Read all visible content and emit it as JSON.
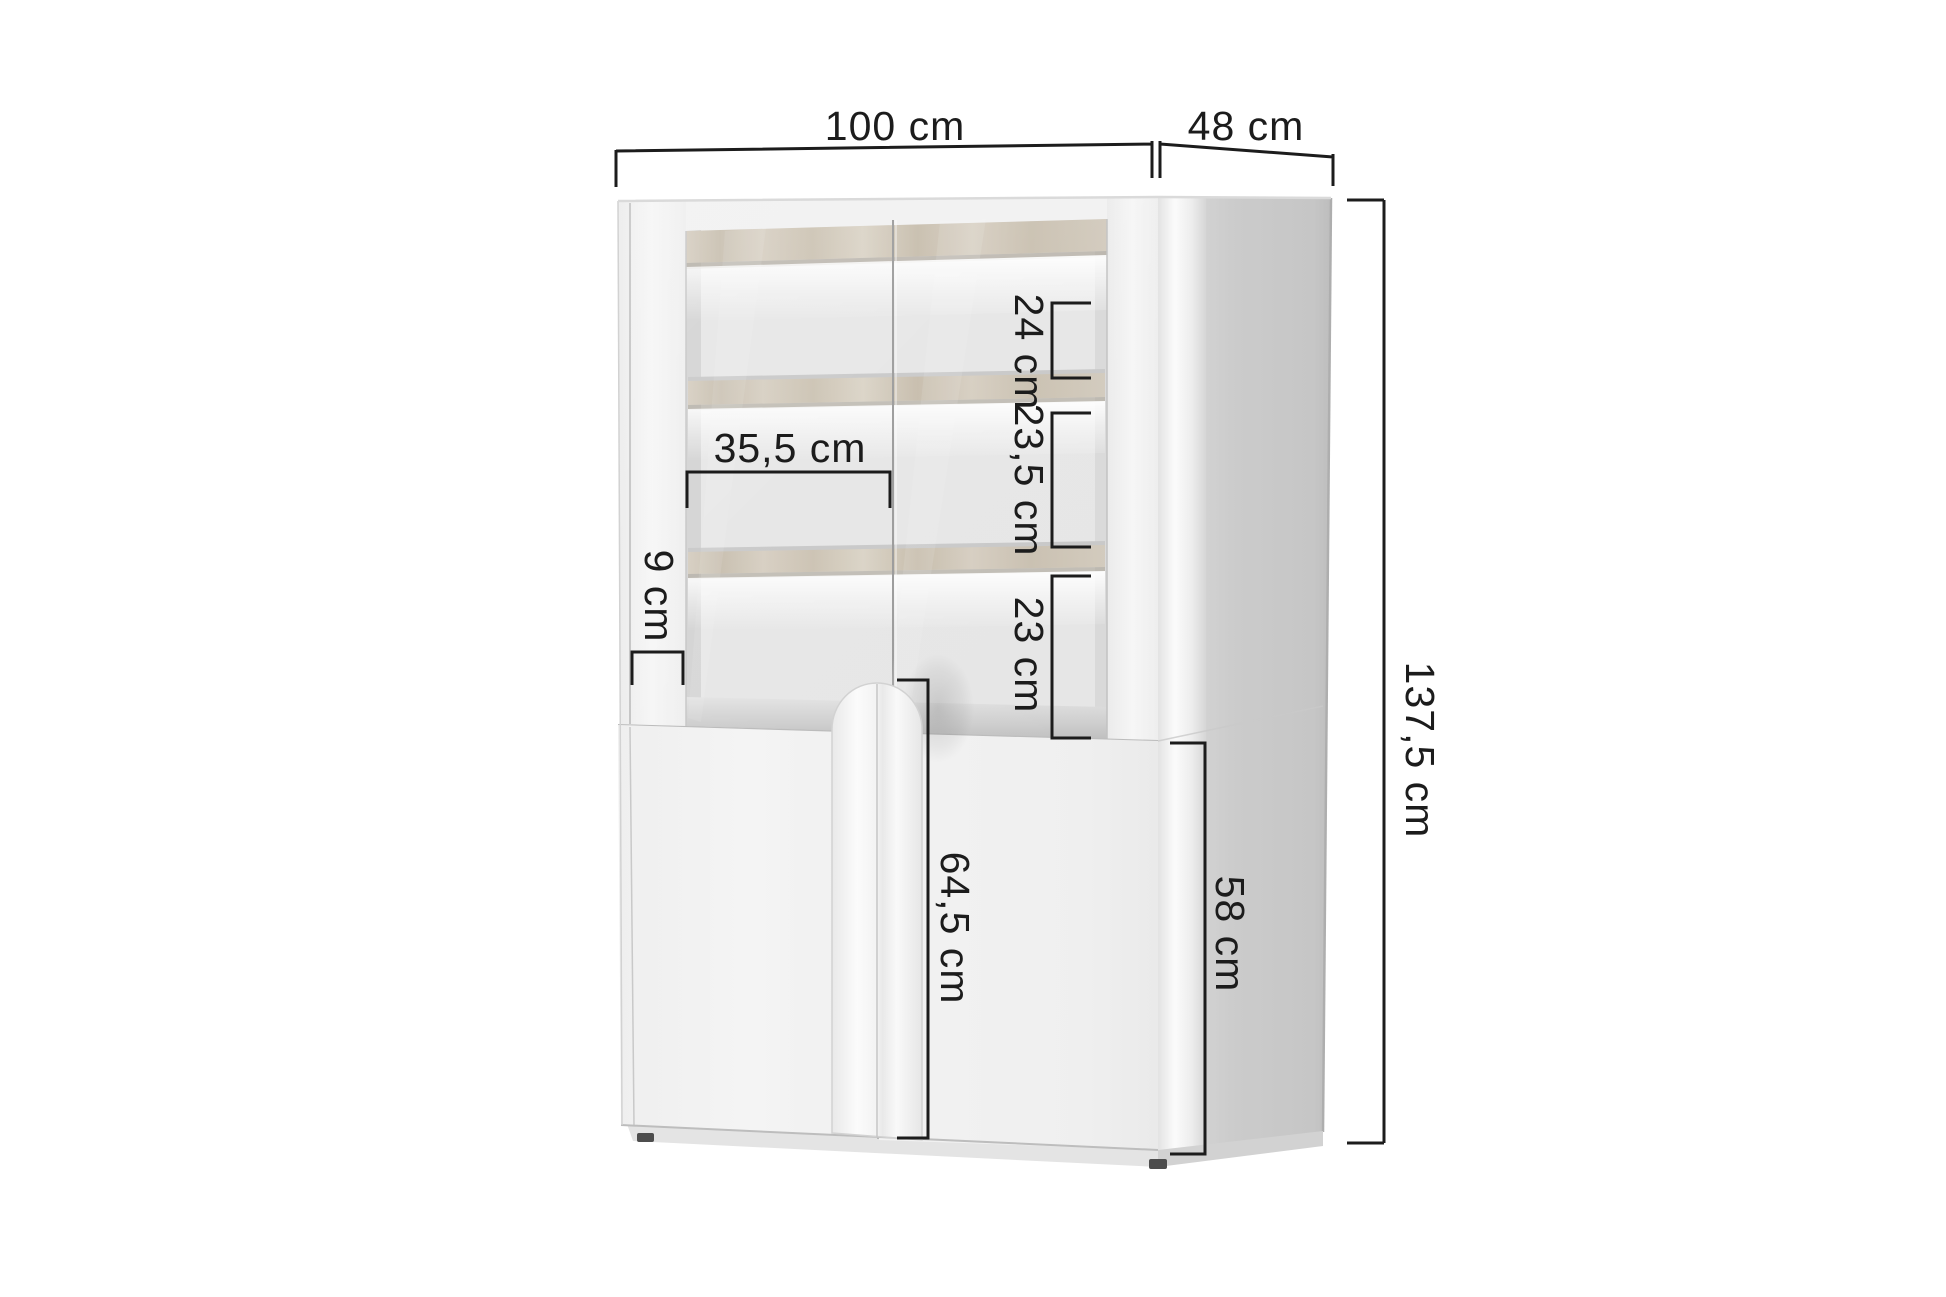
{
  "diagram": {
    "dimensions": {
      "width": {
        "label": "100 cm"
      },
      "depth": {
        "label": "48 cm"
      },
      "height": {
        "label": "137,5 cm"
      },
      "gap_top": {
        "label": "24 cm"
      },
      "gap_middle": {
        "label": "23,5 cm"
      },
      "gap_bottom": {
        "label": "23 cm"
      },
      "inner_width": {
        "label": "35,5 cm"
      },
      "frame_width": {
        "label": "9 cm"
      },
      "door_height": {
        "label": "64,5 cm"
      },
      "base_height": {
        "label": "58 cm"
      }
    }
  },
  "colors": {
    "background": "#ffffff",
    "dimension_lines": "#1c1c1c",
    "cabinet_front": "#f2f2f2",
    "cabinet_side": "#cdcdcd",
    "shelf_wood": "#d1c9bc",
    "led_glow": "#ffffff"
  }
}
